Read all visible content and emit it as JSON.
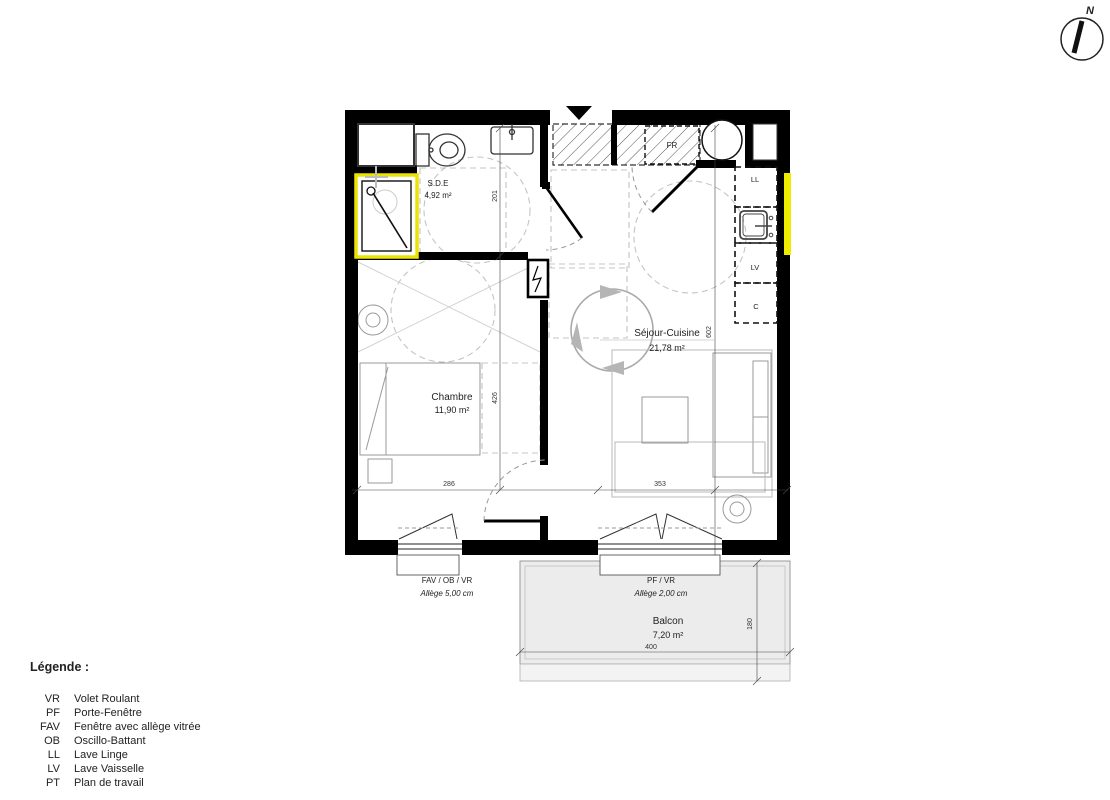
{
  "compass": {
    "north_label": "N"
  },
  "plan": {
    "rooms": {
      "sde": {
        "name": "S.D.E",
        "area": "4,92 m²"
      },
      "chambre": {
        "name": "Chambre",
        "area": "11,90 m²"
      },
      "sejour": {
        "name": "Séjour-Cuisine",
        "area": "21,78 m²"
      },
      "balcon": {
        "name": "Balcon",
        "area": "7,20 m²"
      }
    },
    "appliances": {
      "fr": "FR",
      "ll": "LL",
      "lv": "LV",
      "c": "C"
    },
    "dimensions": {
      "sde_depth": "201",
      "chambre_depth": "426",
      "sejour_depth": "602",
      "chambre_width": "286",
      "sejour_width": "353",
      "balcon_width": "400",
      "balcon_depth": "180"
    },
    "windows": {
      "chambre": {
        "type": "FAV / OB / VR",
        "allege": "Allège  5,00 cm"
      },
      "sejour": {
        "type": "PF / VR",
        "allege": "Allège  2,00 cm"
      }
    }
  },
  "legend": {
    "title": "Légende :",
    "items": [
      {
        "code": "VR",
        "label": "Volet Roulant"
      },
      {
        "code": "PF",
        "label": "Porte-Fenêtre"
      },
      {
        "code": "FAV",
        "label": "Fenêtre avec allège vitrée"
      },
      {
        "code": "OB",
        "label": "Oscillo-Battant"
      },
      {
        "code": "LL",
        "label": "Lave Linge"
      },
      {
        "code": "LV",
        "label": "Lave Vaisselle"
      },
      {
        "code": "PT",
        "label": "Plan de travail"
      }
    ]
  },
  "colors": {
    "wall": "#000000",
    "window_highlight": "#f0ec00",
    "balcony_fill": "#ececec",
    "north_label": "#3946c8"
  }
}
